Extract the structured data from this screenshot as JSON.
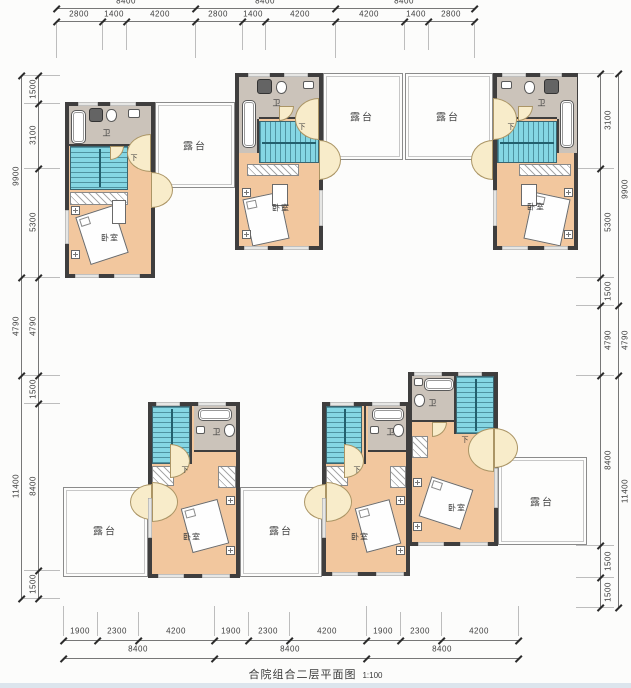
{
  "title": {
    "text": "合院组合二层平面图",
    "scale": "1:100"
  },
  "rooms": {
    "terrace": "露台",
    "bedroom": "卧室",
    "bath": "卫",
    "stairs_down": "下"
  },
  "dims": {
    "top_outer": [
      "8400",
      "8400",
      "8400"
    ],
    "top": [
      "2800",
      "1400",
      "4200",
      "2800",
      "1400",
      "4200",
      "4200",
      "1400",
      "2800"
    ],
    "bottom": [
      "1900",
      "2300",
      "4200",
      "1900",
      "2300",
      "4200",
      "1900",
      "2300",
      "4200"
    ],
    "bottom_outer": [
      "8400",
      "8400",
      "8400"
    ],
    "left": [
      "1500",
      "3100",
      "5300",
      "4790",
      "1500",
      "8400",
      "1500"
    ],
    "left_outer": [
      "9900",
      "4790",
      "11400"
    ],
    "right": [
      "3100",
      "5300",
      "1500",
      "4790",
      "8400",
      "1500",
      "1500"
    ],
    "right_outer": [
      "9900",
      "4790",
      "11400"
    ]
  },
  "colors": {
    "wall": "#3f3e3e",
    "bedroom_floor": "#f2c79e",
    "stair_floor": "#85d6e3",
    "bath_floor": "#cbc3ba",
    "door_swing": "#f8ecca",
    "terrace_border": "#8b8b8b",
    "dim_text": "#3c3c3c",
    "footer_strip": "#dce5ed"
  }
}
